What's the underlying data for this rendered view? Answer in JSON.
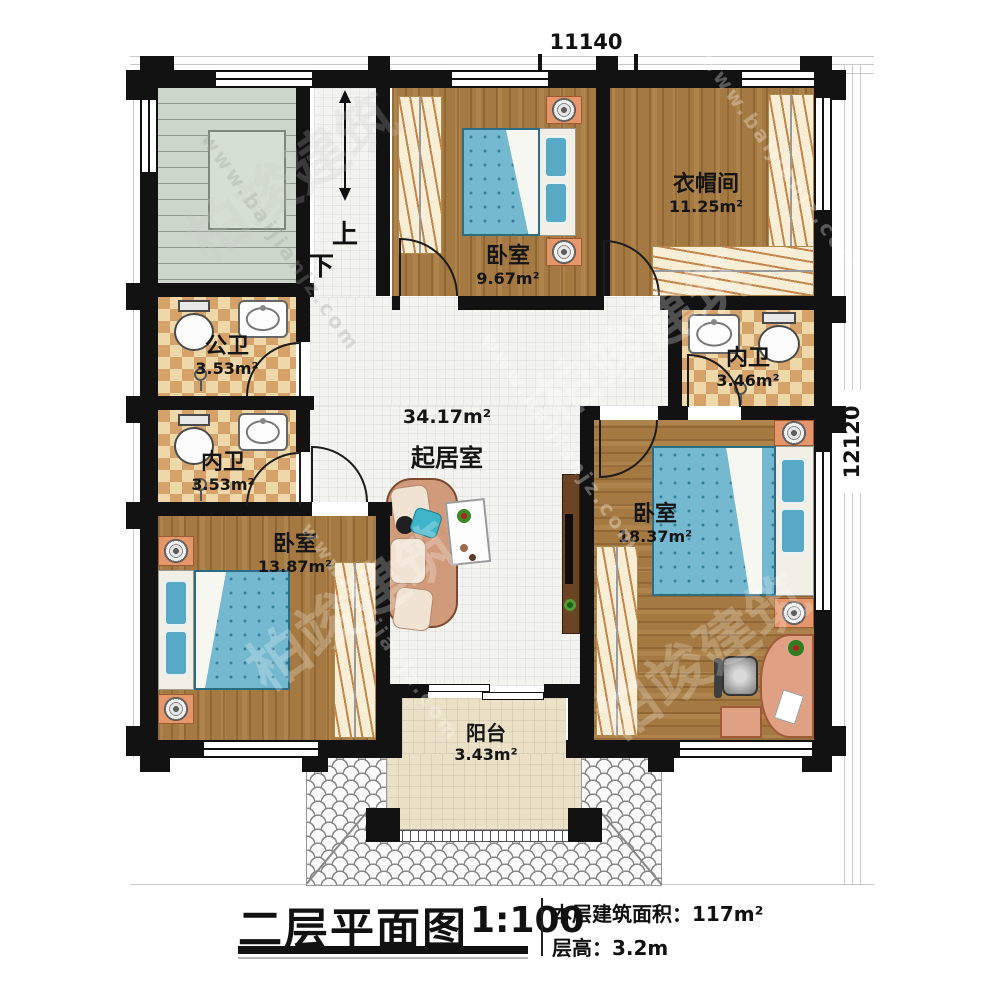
{
  "dimensions": {
    "top": "11140",
    "right": "12120"
  },
  "stairs": {
    "up": "上",
    "down": "下"
  },
  "rooms": {
    "bedroom_top": {
      "name": "卧室",
      "area": "9.67m²"
    },
    "closet": {
      "name": "衣帽间",
      "area": "11.25m²"
    },
    "bath_public": {
      "name": "公卫",
      "area": "3.53m²"
    },
    "bath_en_left": {
      "name": "内卫",
      "area": "3.53m²"
    },
    "bath_en_right": {
      "name": "内卫",
      "area": "3.46m²"
    },
    "living": {
      "name": "起居室",
      "area": "34.17m²"
    },
    "bedroom_left": {
      "name": "卧室",
      "area": "13.87m²"
    },
    "bedroom_right": {
      "name": "卧室",
      "area": "18.37m²"
    },
    "balcony": {
      "name": "阳台",
      "area": "3.43m²"
    }
  },
  "title_block": {
    "title": "二层平面图",
    "scale": "1:100",
    "area_line": "本层建筑面积：117m²",
    "height_line": "层高：3.2m"
  },
  "watermark": {
    "brand": "柏竣建筑",
    "site": "www.baijianjz.com"
  },
  "colors": {
    "wall": "#121212",
    "wood": "#a57a42",
    "bath_tile": "#e7cb97",
    "bed": "#74b9cf",
    "accent_furniture": "#e5976b"
  }
}
